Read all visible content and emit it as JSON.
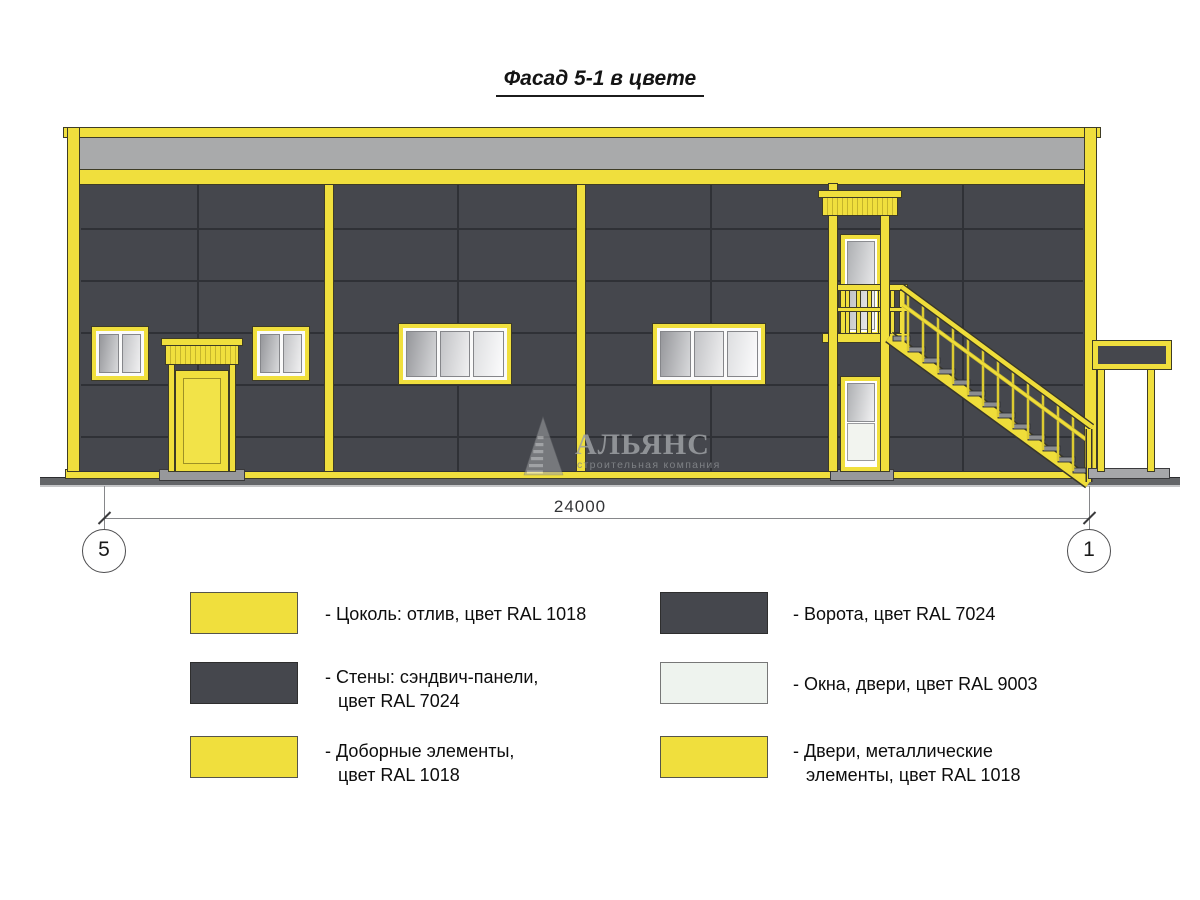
{
  "title": "Фасад 5-1 в цвете",
  "dimension": {
    "value": "24000"
  },
  "axes": {
    "left": "5",
    "right": "1"
  },
  "watermark": {
    "name": "АЛЬЯНС",
    "subtitle": "строительная компания"
  },
  "colors": {
    "ral_1018_yellow": "#F0DF3D",
    "ral_7024_wall": "#45474D",
    "ral_9003_white": "#EEF3EE",
    "parapet_gray": "#A9AAAB"
  },
  "legend": {
    "items": [
      {
        "color": "#F0DF3D",
        "lines": [
          "- Цоколь: отлив, цвет RAL 1018"
        ]
      },
      {
        "color": "#45474D",
        "lines": [
          "- Стены: сэндвич-панели,",
          "цвет RAL 7024"
        ]
      },
      {
        "color": "#F0DF3D",
        "lines": [
          "- Доборные элементы,",
          "цвет RAL 1018"
        ]
      },
      {
        "color": "#45474D",
        "lines": [
          "- Ворота, цвет RAL 7024"
        ]
      },
      {
        "color": "#EEF3EE",
        "lines": [
          "- Окна, двери, цвет RAL 9003"
        ]
      },
      {
        "color": "#F0DF3D",
        "lines": [
          "- Двери, металлические",
          "элементы, цвет RAL 1018"
        ]
      }
    ]
  }
}
